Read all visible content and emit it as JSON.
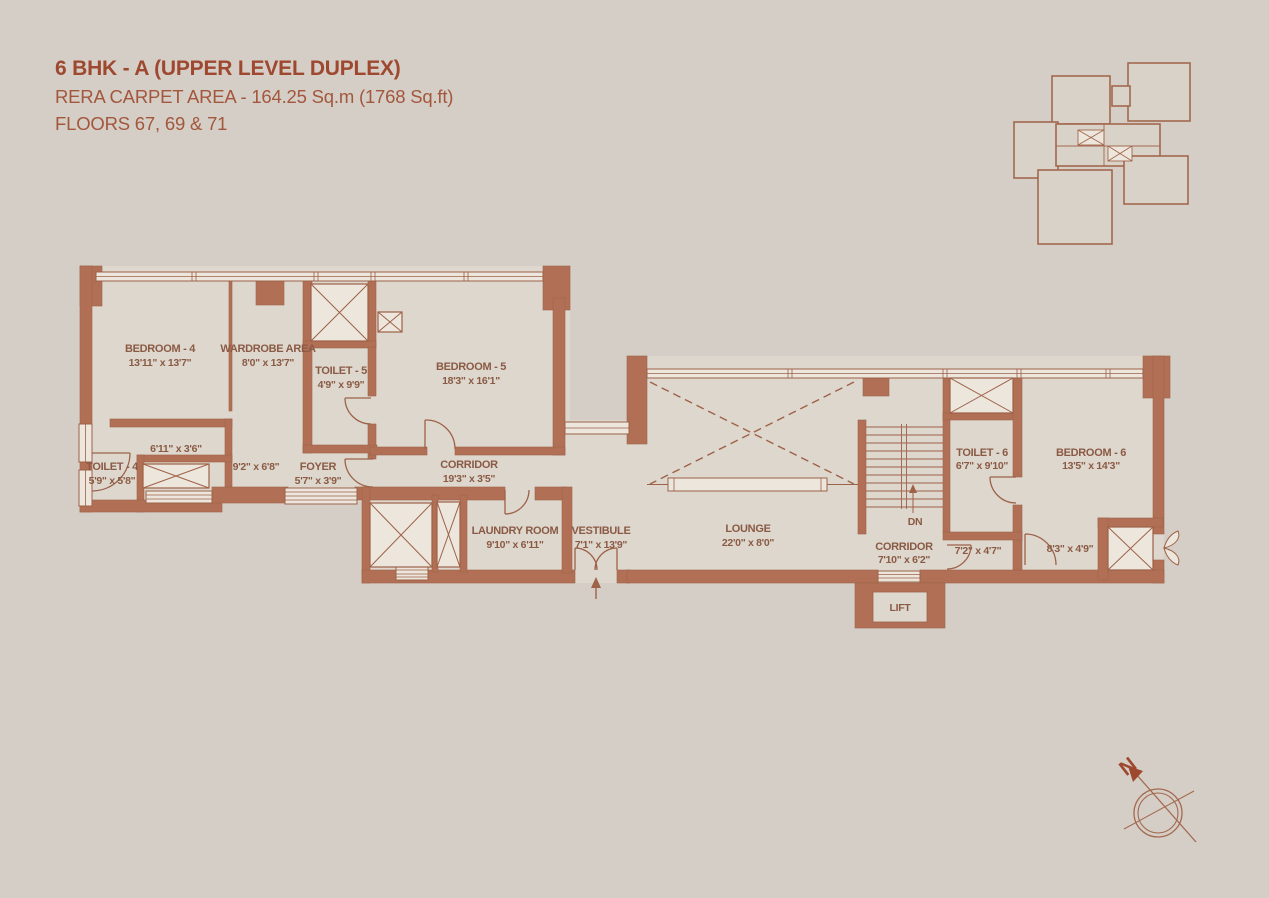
{
  "title": {
    "line1": "6 BHK - A (UPPER LEVEL DUPLEX)",
    "line2": "RERA CARPET AREA - 164.25 Sq.m (1768 Sq.ft)",
    "line3": "FLOORS 67, 69 & 71"
  },
  "rooms": [
    {
      "name": "BEDROOM - 4",
      "dim": "13'11\" x 13'7\""
    },
    {
      "name": "WARDROBE AREA",
      "dim": "8'0\" x 13'7\""
    },
    {
      "name": "TOILET - 5",
      "dim": "4'9\" x 9'9\""
    },
    {
      "name": "BEDROOM - 5",
      "dim": "18'3\" x 16'1\""
    },
    {
      "dim": "6'11\" x 3'6\""
    },
    {
      "name": "TOILET - 4",
      "dim": "5'9\" x 5'8\""
    },
    {
      "dim": "9'2\" x 6'8\""
    },
    {
      "name": "FOYER",
      "dim": "5'7\" x 3'9\""
    },
    {
      "name": "CORRIDOR",
      "dim": "19'3\" x 3'5\""
    },
    {
      "name": "LAUNDRY ROOM",
      "dim": "9'10\" x 6'11\""
    },
    {
      "name": "VESTIBULE",
      "dim": "7'1\" x 13'9\""
    },
    {
      "name": "LOUNGE",
      "dim": "22'0\" x 8'0\""
    },
    {
      "name": "CORRIDOR",
      "dim": "7'10\" x 6'2\""
    },
    {
      "name": "TOILET - 6",
      "dim": "6'7\" x 9'10\""
    },
    {
      "name": "BEDROOM - 6",
      "dim": "13'5\" x 14'3\""
    },
    {
      "dim": "7'2\" x 4'7\""
    },
    {
      "dim": "8'3\" x 4'9\""
    }
  ],
  "annotations": {
    "down": "DN",
    "lift": "LIFT",
    "north": "N"
  },
  "colors": {
    "background": "#d5cec6",
    "floor": "#ded7ce",
    "wall": "#b17055",
    "line": "#9d6248",
    "window": "#ece6dd",
    "label_text": "#8a5a44",
    "title_text": "#9e4830"
  }
}
